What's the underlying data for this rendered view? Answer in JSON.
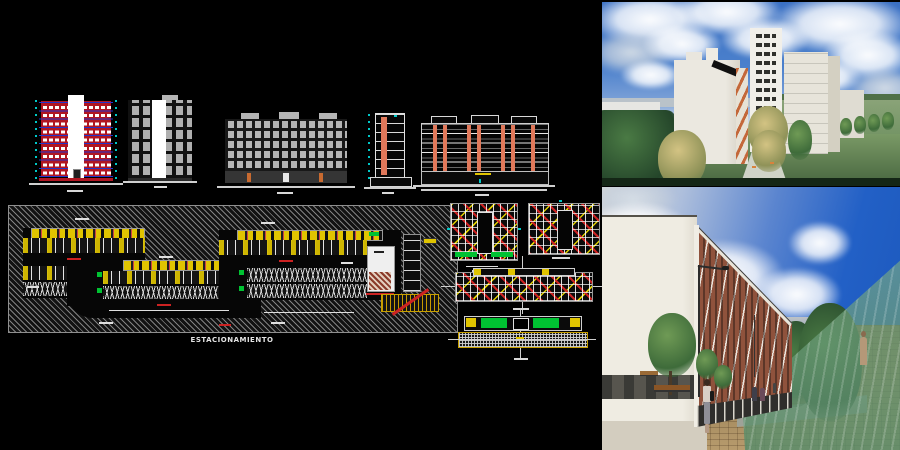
{
  "sheet": {
    "parking_label": "ESTACIONAMIENTO"
  },
  "palette": {
    "canvas_bg": "#000000",
    "cad_red": "#b01622",
    "cad_blue": "#2233cc",
    "cad_cyan": "#00c8c8",
    "cad_yellow": "#e0c400",
    "cad_green": "#00c232",
    "cad_salmon": "#e0785a",
    "cad_gray": "#b5b5b5",
    "hatch_line": "#9a9a9a",
    "sky_top": "#3a70c4",
    "sky_deep": "#1b57bb",
    "lawn_green": "#6f9161",
    "brick": "#8f523c",
    "paving": "#b79b6d",
    "glass_green": "#6ea878"
  },
  "regions": [
    {
      "name": "tower-section-color"
    },
    {
      "name": "tower-elevation-gray"
    },
    {
      "name": "block-elevation-long"
    },
    {
      "name": "narrow-section"
    },
    {
      "name": "block-section-columns"
    },
    {
      "name": "parking-floor-plan"
    },
    {
      "name": "typical-floor-plan-a"
    },
    {
      "name": "typical-floor-plan-b"
    },
    {
      "name": "linear-floor-plan"
    },
    {
      "name": "site-strip-plan"
    },
    {
      "name": "render-aerial"
    },
    {
      "name": "render-street"
    }
  ]
}
